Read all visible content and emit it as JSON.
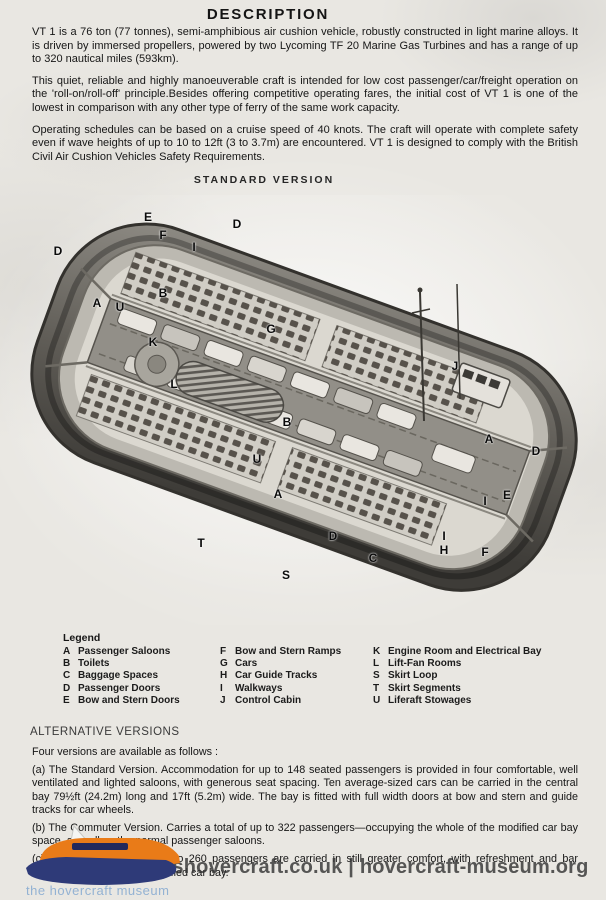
{
  "title": "DESCRIPTION",
  "intro_paragraphs": [
    "VT 1 is a 76 ton (77 tonnes), semi-amphibious air cushion vehicle, robustly constructed in light marine alloys. It is driven by immersed propellers, powered by two Lycoming TF 20 Marine Gas Turbines and has a range of up to 320 nautical miles (593km).",
    "This quiet, reliable and highly manoeuverable craft is intended for low cost passenger/car/freight operation on the 'roll-on/roll-off' principle.Besides offering competitive operating fares, the initial cost of VT 1 is one of the lowest in comparison with any other type of ferry of the same work capacity.",
    "Operating schedules can be based on a cruise speed of 40 knots. The craft will operate with complete safety even if wave heights of up to 10 to 12ft (3 to 3.7m) are encountered. VT 1 is designed to comply with the British Civil Air Cushion Vehicles Safety Requirements."
  ],
  "figure": {
    "heading": "STANDARD VERSION",
    "labels": [
      {
        "t": "E",
        "x": 148,
        "y": 22
      },
      {
        "t": "F",
        "x": 163,
        "y": 40
      },
      {
        "t": "D",
        "x": 237,
        "y": 29
      },
      {
        "t": "D",
        "x": 58,
        "y": 56
      },
      {
        "t": "I",
        "x": 194,
        "y": 52
      },
      {
        "t": "B",
        "x": 163,
        "y": 98
      },
      {
        "t": "A",
        "x": 97,
        "y": 108
      },
      {
        "t": "U",
        "x": 120,
        "y": 112
      },
      {
        "t": "G",
        "x": 271,
        "y": 134
      },
      {
        "t": "K",
        "x": 153,
        "y": 147
      },
      {
        "t": "L",
        "x": 174,
        "y": 189
      },
      {
        "t": "J",
        "x": 455,
        "y": 171
      },
      {
        "t": "B",
        "x": 287,
        "y": 227
      },
      {
        "t": "U",
        "x": 257,
        "y": 264
      },
      {
        "t": "A",
        "x": 278,
        "y": 299
      },
      {
        "t": "D",
        "x": 333,
        "y": 341
      },
      {
        "t": "C",
        "x": 373,
        "y": 363
      },
      {
        "t": "T",
        "x": 201,
        "y": 348
      },
      {
        "t": "S",
        "x": 286,
        "y": 380
      },
      {
        "t": "A",
        "x": 489,
        "y": 244
      },
      {
        "t": "D",
        "x": 536,
        "y": 256
      },
      {
        "t": "E",
        "x": 507,
        "y": 300
      },
      {
        "t": "I",
        "x": 485,
        "y": 306
      },
      {
        "t": "I",
        "x": 444,
        "y": 341
      },
      {
        "t": "H",
        "x": 444,
        "y": 355
      },
      {
        "t": "F",
        "x": 485,
        "y": 357
      }
    ]
  },
  "legend": {
    "heading": "Legend",
    "columns": [
      [
        {
          "key": "A",
          "label": "Passenger Saloons"
        },
        {
          "key": "B",
          "label": "Toilets"
        },
        {
          "key": "C",
          "label": "Baggage Spaces"
        },
        {
          "key": "D",
          "label": "Passenger Doors"
        },
        {
          "key": "E",
          "label": "Bow and Stern Doors"
        }
      ],
      [
        {
          "key": "F",
          "label": "Bow and Stern Ramps"
        },
        {
          "key": "G",
          "label": "Cars"
        },
        {
          "key": "H",
          "label": "Car Guide Tracks"
        },
        {
          "key": "I",
          "label": "Walkways"
        },
        {
          "key": "J",
          "label": "Control Cabin"
        }
      ],
      [
        {
          "key": "K",
          "label": "Engine Room and Electrical Bay"
        },
        {
          "key": "L",
          "label": "Lift-Fan Rooms"
        },
        {
          "key": "S",
          "label": "Skirt Loop"
        },
        {
          "key": "T",
          "label": "Skirt Segments"
        },
        {
          "key": "U",
          "label": "Liferaft Stowages"
        }
      ]
    ]
  },
  "alternative": {
    "heading": "ALTERNATIVE VERSIONS",
    "intro": "Four versions are available as follows :",
    "items": [
      "(a) The Standard Version. Accommodation for up to 148 seated passengers is provided in four comfortable, well ventilated and lighted saloons, with generous seat spacing. Ten average-sized cars can be carried in the central bay 79½ft (24.2m) long and 17ft (5.2m) wide. The bay is fitted with full width doors at bow and stern and guide tracks for car wheels.",
      "(b) The Commuter Version. Carries a total of up to 322 passengers—occupying the whole of the modified car bay space, as well as the normal passenger saloons.",
      "(c) The Tourist Version. Up to 260 passengers are carried in still greater comfort, with refreshment and bar facilities provided in the modified car bay."
    ],
    "fragment": "additional seats."
  },
  "watermark": "jameshovercraft.co.uk | hovercraft-museum.org",
  "logo_caption": "the hovercraft museum"
}
